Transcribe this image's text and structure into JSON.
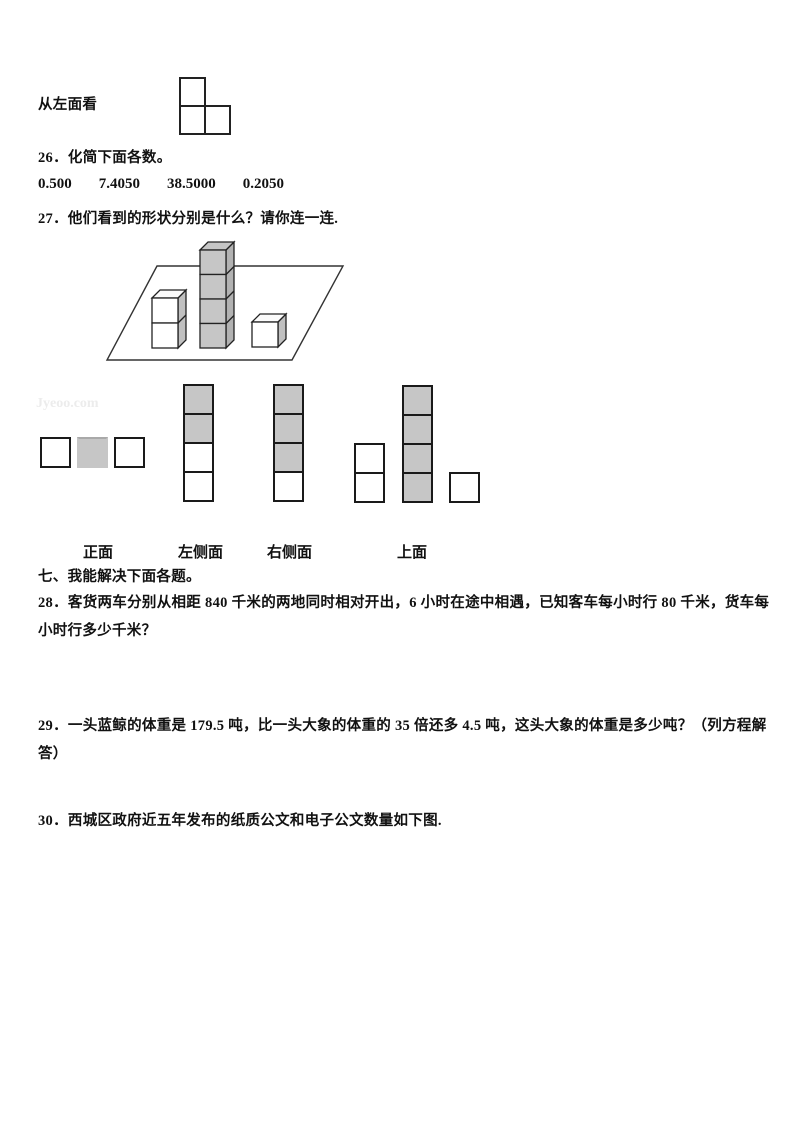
{
  "page": {
    "watermark": "Jyeoo.com"
  },
  "top_figure": {
    "label": "从左面看",
    "shape": "L-tromino, one square on top-left of a two-square bottom row"
  },
  "q26": {
    "text": "26．化简下面各数。",
    "values": [
      "0.500",
      "7.4050",
      "38.5000",
      "0.2050"
    ]
  },
  "q27": {
    "text": "27．他们看到的形状分别是什么？请你连一连."
  },
  "scene": {
    "description": "three cube stacks on a parallelogram plane",
    "stacks": [
      {
        "cubes": 2,
        "shaded": false
      },
      {
        "cubes": 4,
        "shaded": true
      },
      {
        "cubes": 1,
        "shaded": false
      }
    ]
  },
  "views": {
    "front": {
      "label": "正面",
      "cells": [
        "white",
        "gray",
        "white"
      ]
    },
    "left": {
      "label": "左侧面",
      "cells": [
        "gray",
        "gray",
        "white",
        "white"
      ]
    },
    "right": {
      "label": "右侧面",
      "cells": [
        "gray",
        "gray",
        "gray",
        "white"
      ]
    },
    "top": {
      "label": "上面",
      "columns": [
        {
          "cells": [
            "white",
            "white"
          ]
        },
        {
          "cells": [
            "gray",
            "gray",
            "gray",
            "gray"
          ]
        },
        {
          "cells": [
            "white"
          ]
        }
      ]
    }
  },
  "section7": {
    "title": "七、我能解决下面各题。"
  },
  "q28": {
    "text": "28．客货两车分别从相距 840 千米的两地同时相对开出，6 小时在途中相遇，已知客车每小时行 80 千米，货车每小时行多少千米？"
  },
  "q29": {
    "text": "29．一头蓝鲸的体重是 179.5 吨，比一头大象的体重的 35 倍还多 4.5 吨，这头大象的体重是多少吨？（列方程解答）"
  },
  "q30": {
    "text": "30．西城区政府近五年发布的纸质公文和电子公文数量如下图."
  },
  "colors": {
    "gray_fill": "#c6c6c6",
    "gray_side": "#b2b2b2",
    "border": "#1a1a1a"
  }
}
